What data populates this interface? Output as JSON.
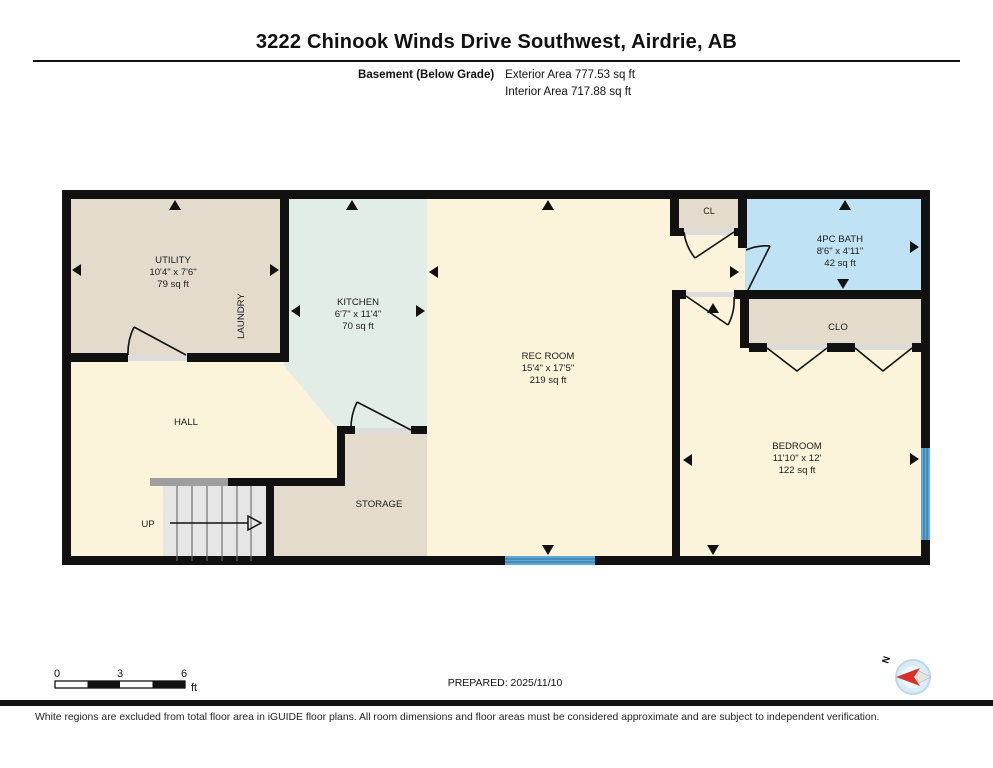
{
  "title": "3222 Chinook Winds Drive Southwest, Airdrie, AB",
  "floor": {
    "name": "Basement (Below Grade)",
    "exterior_area": "Exterior Area 777.53 sq ft",
    "interior_area": "Interior Area 717.88 sq ft"
  },
  "rooms": {
    "utility": {
      "name": "UTILITY",
      "dims": "10'4\" x 7'6\"",
      "area": "79 sq ft"
    },
    "laundry": {
      "name": "LAUNDRY"
    },
    "kitchen": {
      "name": "KITCHEN",
      "dims": "6'7\" x 11'4\"",
      "area": "70 sq ft"
    },
    "rec_room": {
      "name": "REC ROOM",
      "dims": "15'4\" x 17'5\"",
      "area": "219 sq ft"
    },
    "hall": {
      "name": "HALL"
    },
    "storage": {
      "name": "STORAGE"
    },
    "stairs": {
      "label": "UP"
    },
    "cl": {
      "name": "CL"
    },
    "bath": {
      "name": "4PC BATH",
      "dims": "8'6\" x 4'11\"",
      "area": "42 sq ft"
    },
    "clo": {
      "name": "CLO"
    },
    "bedroom": {
      "name": "BEDROOM",
      "dims": "11'10\" x 12'",
      "area": "122 sq ft"
    }
  },
  "scale_bar": {
    "start": "0",
    "mid": "3",
    "end": "6",
    "unit": "ft"
  },
  "prepared": "PREPARED: 2025/11/10",
  "compass": {
    "label": "N"
  },
  "footer": "White regions are excluded from total floor area in iGUIDE floor plans. All room dimensions and floor areas must be considered approximate and are subject to independent verification.",
  "colors": {
    "wall": "#111111",
    "room_yellow": "#FBF3DA",
    "room_beige": "#E3DBCB",
    "room_teal": "#E3EDE8",
    "room_blue": "#BFE3F4",
    "window_blue": "#5FA8D6",
    "stair_gray": "#E6E6E6",
    "railing_gray": "#9E9E9E",
    "threshold_gray": "#DCDCDC",
    "compass_red": "#D93025"
  }
}
